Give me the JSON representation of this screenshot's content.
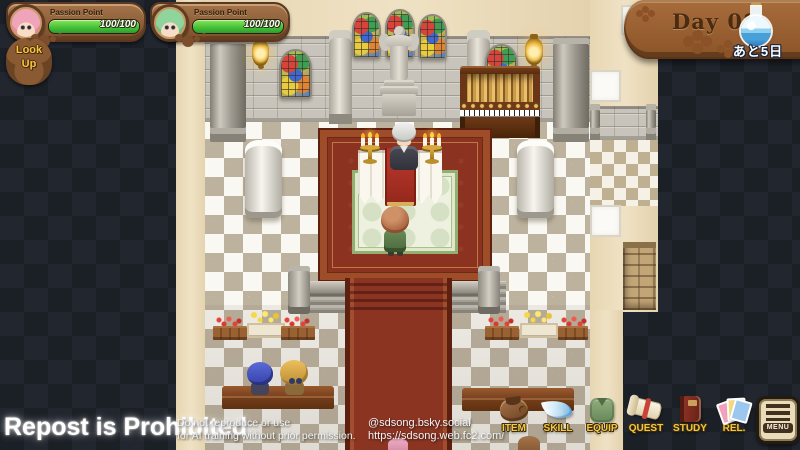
{
  "hud": {
    "party": [
      {
        "portrait": "pink-haired-character",
        "label": "Passion Point",
        "value": "100/100",
        "fill_pct": 100
      },
      {
        "portrait": "green-haired-character",
        "label": "Passion Point",
        "value": "100/100",
        "fill_pct": 100
      }
    ],
    "look_up": {
      "line1": "Look",
      "line2": "Up"
    },
    "day_banner": {
      "label": "Day 08",
      "days_left": "あと5日",
      "icon": "potion-flask-icon"
    }
  },
  "watermark": {
    "headline": "Repost is Prohibited",
    "notice_line1": "Do not reproduce or use",
    "notice_line2": "for AI training without prior permission.",
    "social_handle": "@sdsong.bsky.social",
    "website": "https://sdsong.web.fc2.com/"
  },
  "menu": {
    "items": [
      {
        "label": "ITEM",
        "icon": "bag-icon"
      },
      {
        "label": "SKILL",
        "icon": "wing-icon"
      },
      {
        "label": "EQUIP",
        "icon": "vest-icon"
      },
      {
        "label": "QUEST",
        "icon": "scroll-icon"
      },
      {
        "label": "STUDY",
        "icon": "book-icon"
      },
      {
        "label": "REL.",
        "icon": "cards-icon"
      }
    ],
    "menu_button": "MENU"
  },
  "colors": {
    "gauge-green": "#46c23a",
    "carpet-red": "#8c3220",
    "menu-gold": "#f6c93c"
  }
}
